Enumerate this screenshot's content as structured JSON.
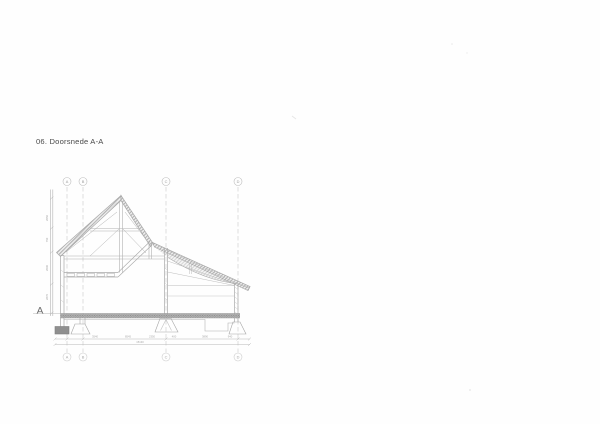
{
  "page": {
    "title": "06. Doorsnede A-A",
    "section_marker": "A"
  },
  "grid": {
    "letters": [
      "A",
      "B",
      "C",
      "D"
    ]
  },
  "dimensions": {
    "row1": [
      "3540",
      "8545",
      "2350",
      "400",
      "3890",
      "940"
    ],
    "total": "15130",
    "height_scale": [
      "2650",
      "750",
      "2600",
      "2870"
    ]
  },
  "colors": {
    "paper": "#fefefe",
    "line_main": "#a9a9a9",
    "line_thin": "#bdbdbd",
    "grid_dash": "#c9c9c9",
    "floor_band": "#8f8f8f",
    "title_text": "#4a4a4a"
  }
}
